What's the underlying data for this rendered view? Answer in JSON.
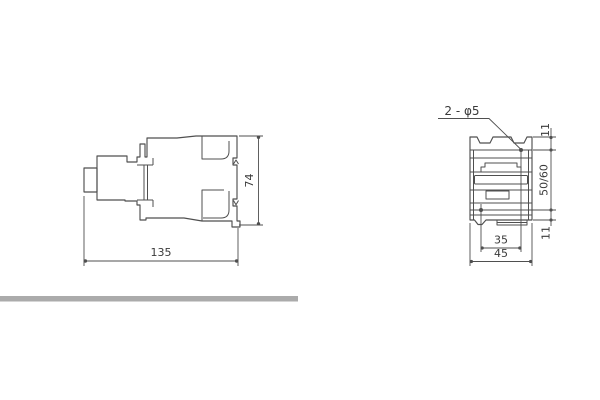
{
  "drawing": {
    "side_view": {
      "width": "135",
      "height": "74"
    },
    "front_view": {
      "holes_callout": "2 - φ5",
      "top_hole_offset": "11",
      "hole_vertical_spacing": "50/60",
      "bottom_hole_offset": "11",
      "hole_horizontal_spacing": "35",
      "width": "45"
    },
    "colors": {
      "line": "#4f4f4f",
      "text": "#3a3a3a",
      "divider_bar": "#ababab",
      "background": "#ffffff"
    }
  }
}
